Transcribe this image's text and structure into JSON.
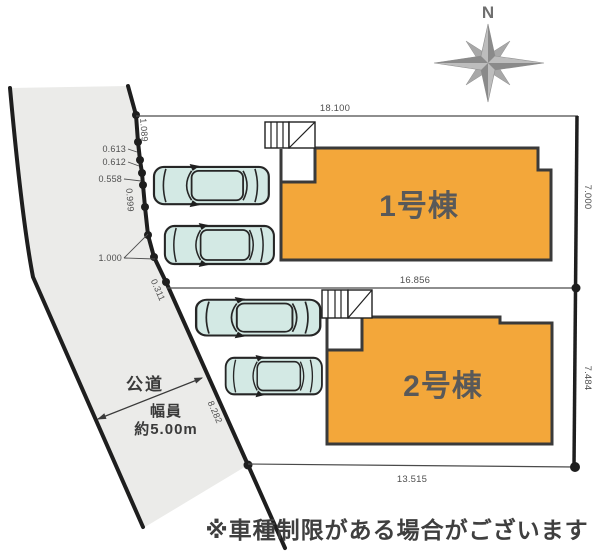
{
  "caption": "※車種制限がある場合がございます",
  "compass": {
    "north_label": "N"
  },
  "road": {
    "name": "公道",
    "width_caption": "幅員",
    "width_value": "約5.00m"
  },
  "buildings": [
    {
      "label": "1号棟"
    },
    {
      "label": "2号棟"
    }
  ],
  "dimensions": {
    "lot1_width": "18.100",
    "lot1_depth": "7.000",
    "lot2_width": "16.856",
    "lot2_depth": "7.484",
    "lot2_bottom_width": "13.515",
    "boundary": {
      "seg1": "1.089",
      "seg2": "0.613",
      "seg3": "0.612",
      "seg4": "0.558",
      "seg5": "0.999",
      "seg6": "1.000",
      "seg7": "0.311",
      "seg8": "8.282"
    }
  },
  "colors": {
    "building-fill": "#F3A73A",
    "building-stroke": "#3A3A3A",
    "road-fill": "#EBEBE9",
    "line-dark": "#1E1E1E",
    "line-mid": "#4A4A4A",
    "dim-text": "#4F4F4F",
    "label-text": "#595959",
    "road-text": "#3A3A3A",
    "car-fill": "#D3E9E4",
    "car-stroke": "#262626",
    "compass-light": "#BDBDBD",
    "compass-mid": "#A8A8A8",
    "compass-dark": "#8A8A8A",
    "caption-text": "#3F3F3F"
  }
}
